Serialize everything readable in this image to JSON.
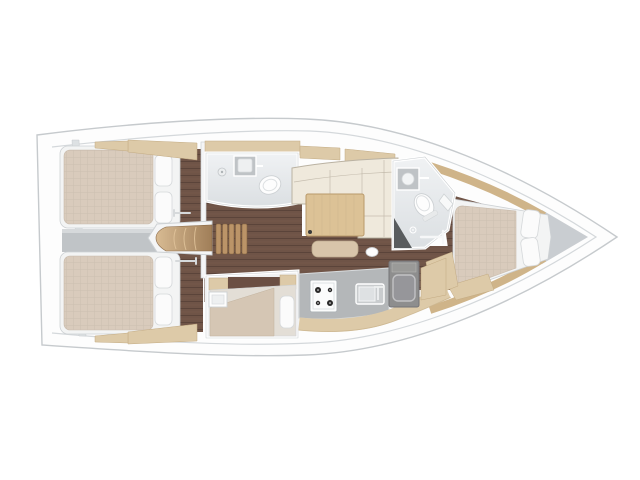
{
  "plan": {
    "label": "sailing-yacht-interior-floor-plan-top-view-bow-right",
    "areas": [
      "aft-cabin-port",
      "aft-cabin-starboard",
      "companionway-stairs",
      "aft-head-bathroom",
      "salon",
      "forward-head-bathroom",
      "galley",
      "single-berth-cabin",
      "forward-cabin",
      "anchor-locker"
    ],
    "features": [
      "double-bed",
      "pillows",
      "toilet",
      "washbasin",
      "shower-seat",
      "l-shaped-sofa",
      "saloon-table",
      "bench-seat",
      "stove-4-burners",
      "galley-sink",
      "fridge-box",
      "engine-cover-steps",
      "door-handle"
    ]
  },
  "colors": {
    "page_bg": "#ffffff",
    "hull_fill": "#fdfdfd",
    "hull_stroke": "#c6cacd",
    "deck_line": "#d4d8db",
    "bow_locker": "#c9cdd1",
    "floor_dark": "#6f5447",
    "floor_line": "#5b443a",
    "floor_line2": "#7d5e4f",
    "wood_light": "#ddcaa8",
    "wood_edge": "#c3ab83",
    "wood_mid": "#cfb489",
    "table_wood": "#dcc296",
    "table_edge": "#b9996a",
    "stairs_light": "#d8bb93",
    "stairs_dark": "#a07e58",
    "step_wood": "#bb9468",
    "step_edge": "#846442",
    "mattress": "#d9cbbc",
    "mattress_line": "#c8baab",
    "bed_frame": "#f3f4f4",
    "frame_edge": "#cdd1d4",
    "pillow": "#fbfbfb",
    "pillow_edge": "#d5d8da",
    "sofa": "#efe9dc",
    "sofa_edge": "#bab2a2",
    "gray_panel": "#c0c4c7",
    "gray_panel_light": "#d6d9db",
    "wall_white": "#f4f5f6",
    "bath_floor_a": "#f0f2f4",
    "bath_floor_b": "#dbdfe2",
    "fixture_gray": "#bfc3c6",
    "counter_gray": "#b4b7b9",
    "counter_edge": "#d8dbdd",
    "dark_unit": "#8e8e8e",
    "dark_unit_edge": "#747478",
    "dark_shelf": "#6b4f43",
    "dark_seat": "#595c5e",
    "stove_white": "#fbfcfc",
    "burner": "#2a2a2a",
    "white_fixture": "#fdfdfd"
  }
}
